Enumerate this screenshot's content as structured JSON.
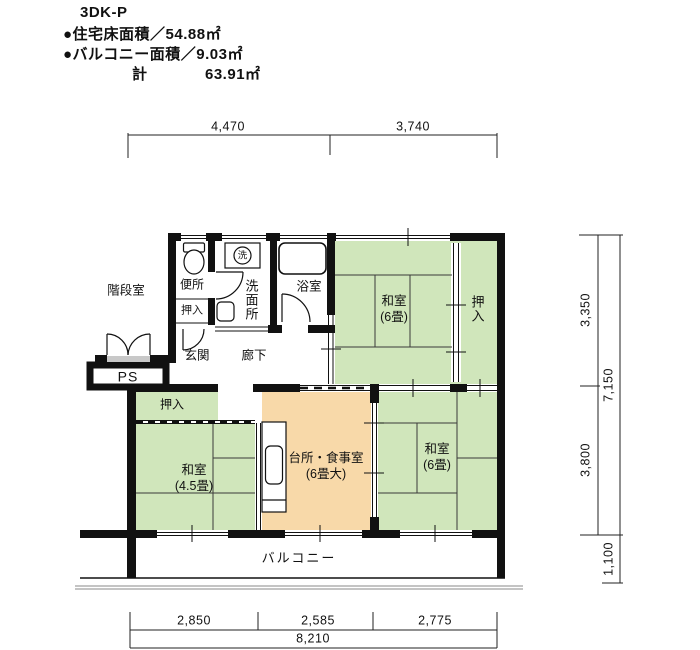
{
  "header": {
    "title": "3DK-P",
    "area_line1": "●住宅床面積／54.88㎡",
    "area_line2": "●バルコニー面積／9.03㎡",
    "total_label": "計",
    "total_value": "63.91㎡"
  },
  "dimensions": {
    "top": [
      "4,470",
      "3,740"
    ],
    "right": {
      "upper": "3,350",
      "lower": "3,800",
      "total": "7,150",
      "balcony": "1,100"
    },
    "bottom": {
      "segments": [
        "2,850",
        "2,585",
        "2,775"
      ],
      "total": "8,210"
    }
  },
  "rooms": {
    "stairwell": "階段室",
    "toilet": "便所",
    "hall_closet": "押入",
    "entrance": "玄関",
    "corridor": "廊下",
    "washroom": "洗面所",
    "bathroom": "浴室",
    "pipe_space": "PS",
    "tatami_ne": {
      "name": "和室",
      "size": "(6畳)"
    },
    "closet_ne": "押入",
    "tatami_sw": {
      "name": "和室",
      "size": "(4.5畳)"
    },
    "closet_sw": "押入",
    "kitchen": {
      "name": "台所・食事室",
      "size": "(6畳大)"
    },
    "tatami_se": {
      "name": "和室",
      "size": "(6畳)"
    },
    "balcony": "バルコニー"
  },
  "fixtures": {
    "washing_machine": "洗"
  },
  "colors": {
    "tatami_green": "#d0e6bb",
    "kitchen_orange": "#f8d9a9",
    "wall_black": "#111111"
  }
}
